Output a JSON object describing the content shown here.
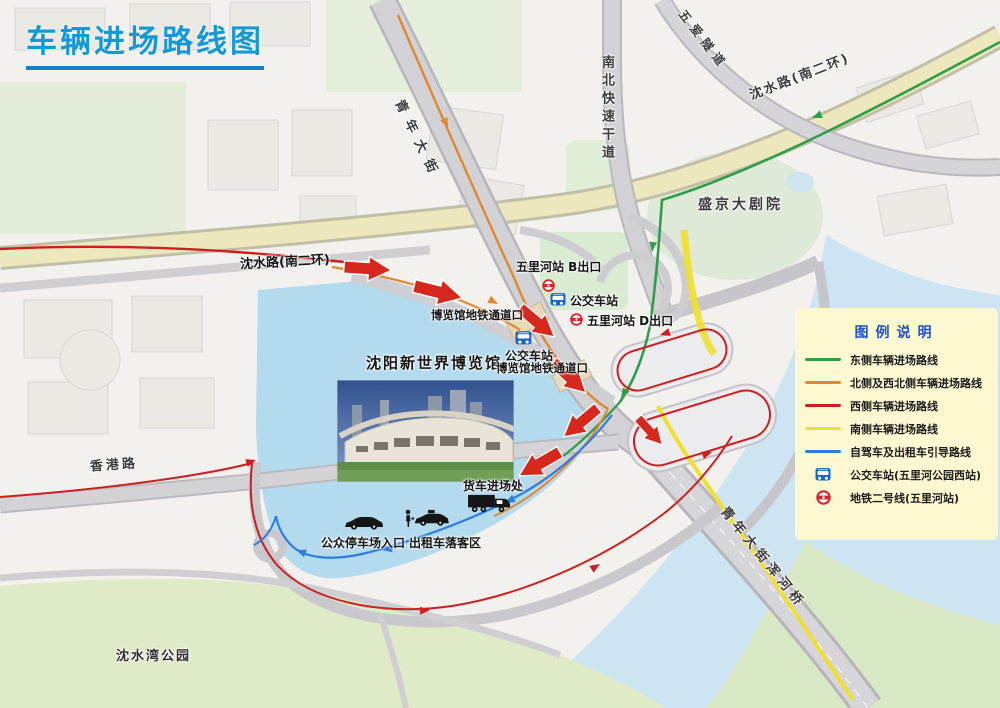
{
  "title": "车辆进场路线图",
  "legend": {
    "title": "图例说明",
    "items": [
      {
        "label": "东侧车辆进场路线",
        "color": "#2f9e48",
        "type": "line"
      },
      {
        "label": "北侧及西北侧车辆进场路线",
        "color": "#e0882e",
        "type": "line"
      },
      {
        "label": "西侧车辆进场路线",
        "color": "#cc2020",
        "type": "line"
      },
      {
        "label": "南侧车辆进场路线",
        "color": "#efdf2e",
        "type": "line"
      },
      {
        "label": "自驾车及出租车引导路线",
        "color": "#2d7ce0",
        "type": "line"
      },
      {
        "label": "公交车站(五里河公园西站)",
        "color": "#1767c9",
        "type": "bus-icon"
      },
      {
        "label": "地铁二号线(五里河站)",
        "color": "#d42626",
        "type": "metro-icon"
      }
    ]
  },
  "map": {
    "roads": {
      "qingnian_street": "青年大街",
      "nanbei_expressway": "南北快速干道",
      "wuai_tunnel": "五爱隧道",
      "shenshui_road_ne": "沈水路(南二环)",
      "shenshui_road_w": "沈水路(南二环)",
      "hongkong_road": "香港路",
      "hunhe_bridge": "青年大街浑河桥"
    },
    "places": {
      "theatre": "盛京大剧院",
      "park": "沈水湾公园",
      "expo": "沈阳新世界博览馆"
    },
    "stations": {
      "wulihe_exit_b": "五里河站 B出口",
      "wulihe_exit_d": "五里河站 D出口",
      "bus_stop_north": "公交车站",
      "bus_stop_west": "公交车站",
      "metro_passage_north": "博览馆地铁通道口",
      "metro_passage_west": "博览馆地铁通道口"
    },
    "facilities": {
      "truck_entrance": "货车进场处",
      "parking_entrance": "公众停车场入口",
      "taxi_dropoff": "出租车落客区"
    }
  },
  "colors": {
    "title_accent": "#1599d4",
    "route_east": "#2f9e48",
    "route_north_northwest": "#e0882e",
    "route_west": "#cc2020",
    "route_south": "#efdf2e",
    "route_guide": "#2d7ce0",
    "bus_icon": "#1767c9",
    "metro_icon": "#d42626",
    "venue_area": "#b4daee",
    "legend_bg": "#fcf9d2"
  }
}
